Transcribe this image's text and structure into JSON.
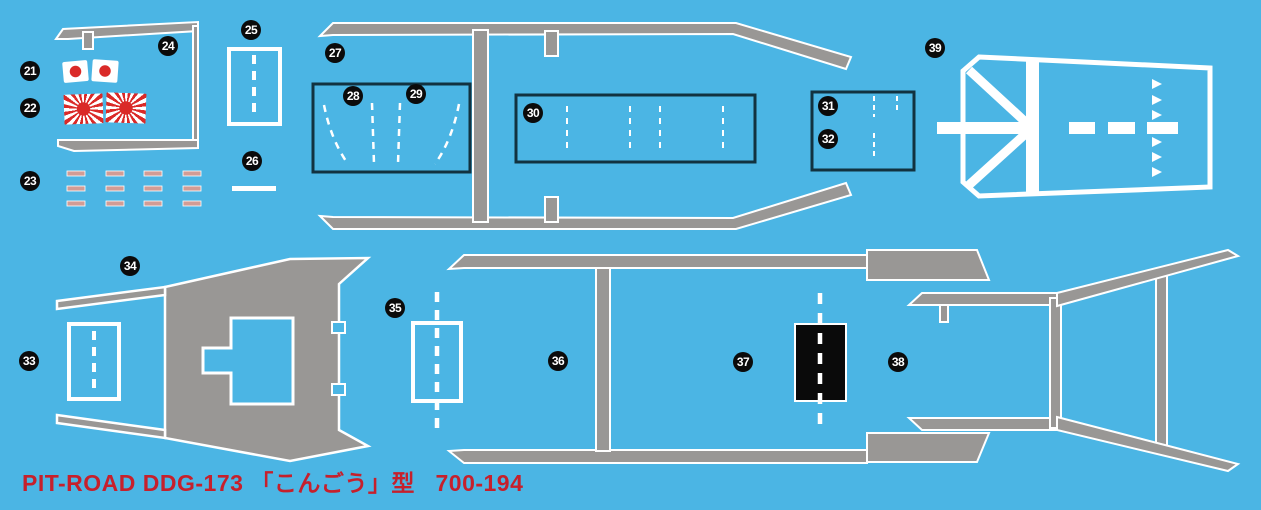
{
  "sheet": {
    "description": "PIT-ROAD 1/700 waterslide decal sheet for JMSDF DDG-173 Kongou class",
    "colors": {
      "background": "#4bb5e4",
      "deck_gray": "#999795",
      "outline_white": "#ffffff",
      "box_border_navy": "#123240",
      "flag_red": "#da2a28",
      "draft_mark_pink": "#d29c95",
      "helipad_black": "#0a0a0a",
      "footer_red": "#c6202c",
      "badge_black": "#0b0b0b"
    },
    "footer": {
      "text": "PIT-ROAD DDG-173 「こんごう」型   700-194"
    },
    "markers": [
      {
        "label": "21",
        "x": 30,
        "y": 71
      },
      {
        "label": "22",
        "x": 30,
        "y": 108
      },
      {
        "label": "23",
        "x": 30,
        "y": 181
      },
      {
        "label": "24",
        "x": 168,
        "y": 46
      },
      {
        "label": "25",
        "x": 251,
        "y": 30
      },
      {
        "label": "26",
        "x": 252,
        "y": 161
      },
      {
        "label": "27",
        "x": 335,
        "y": 53
      },
      {
        "label": "28",
        "x": 353,
        "y": 96
      },
      {
        "label": "29",
        "x": 416,
        "y": 94
      },
      {
        "label": "30",
        "x": 533,
        "y": 113
      },
      {
        "label": "31",
        "x": 828,
        "y": 106
      },
      {
        "label": "32",
        "x": 828,
        "y": 139
      },
      {
        "label": "33",
        "x": 29,
        "y": 361
      },
      {
        "label": "34",
        "x": 130,
        "y": 266
      },
      {
        "label": "35",
        "x": 395,
        "y": 308
      },
      {
        "label": "36",
        "x": 558,
        "y": 361
      },
      {
        "label": "37",
        "x": 743,
        "y": 362
      },
      {
        "label": "38",
        "x": 898,
        "y": 362
      },
      {
        "label": "39",
        "x": 935,
        "y": 48
      }
    ],
    "decals": [
      {
        "id": "21",
        "name": "hinomaru-flags",
        "count": 2
      },
      {
        "id": "22",
        "name": "rising-sun-ensigns",
        "count": 2
      },
      {
        "id": "23",
        "name": "draft-marks",
        "rows": 3,
        "cols": 4
      },
      {
        "id": "24",
        "name": "bridge-walkway-outline"
      },
      {
        "id": "25",
        "name": "deck-panel-dashed"
      },
      {
        "id": "26",
        "name": "deck-line"
      },
      {
        "id": "27",
        "name": "midship-walkway-outline"
      },
      {
        "id": "28-29",
        "name": "vls-blast-markings-forward"
      },
      {
        "id": "30",
        "name": "vls-deck-markings-aft"
      },
      {
        "id": "31-32",
        "name": "deck-hatch-markings"
      },
      {
        "id": "33",
        "name": "forward-deck-panel-dashed"
      },
      {
        "id": "34",
        "name": "bow-deck-plate"
      },
      {
        "id": "35",
        "name": "amidships-deck-panel-dashed"
      },
      {
        "id": "36-37",
        "name": "main-deck-walkways"
      },
      {
        "id": "37",
        "name": "helipad-black-panel"
      },
      {
        "id": "38",
        "name": "stern-walkways"
      },
      {
        "id": "39",
        "name": "helicopter-deck-markings"
      }
    ]
  }
}
